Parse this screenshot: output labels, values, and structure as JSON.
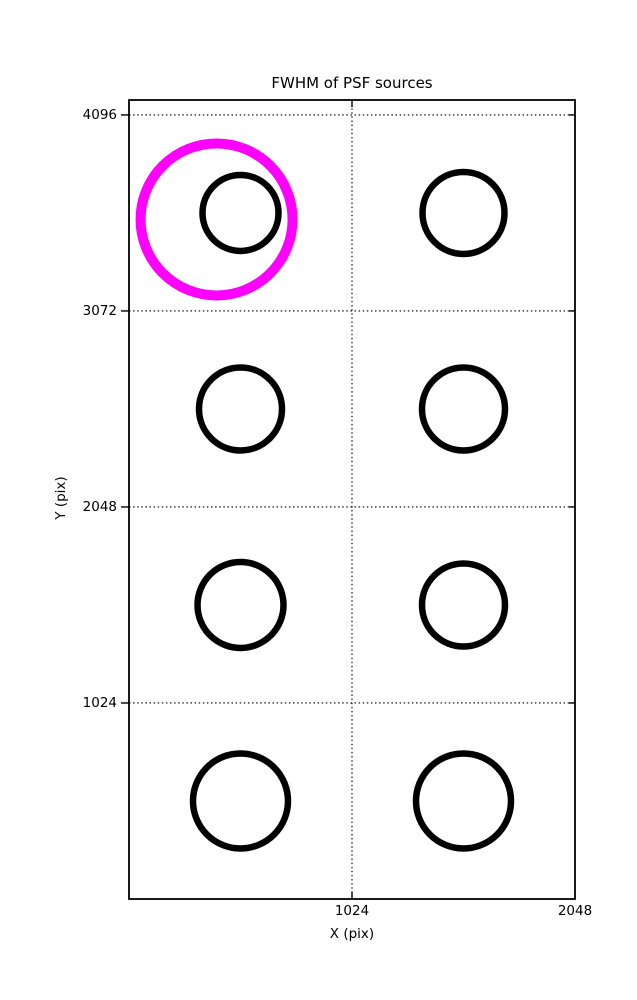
{
  "chart_data": {
    "type": "scatter",
    "title": "FWHM of PSF sources",
    "xlabel": "X (pix)",
    "ylabel": "Y (pix)",
    "xlim": [
      0,
      2048
    ],
    "ylim": [
      0,
      4174
    ],
    "xticks": [
      1024,
      2048
    ],
    "yticks": [
      1024,
      2048,
      3072,
      4096
    ],
    "grid": "dotted",
    "legend": "none",
    "marker_color": "#000000",
    "highlight_color": "#ff00ff",
    "points": [
      {
        "x": 512,
        "y": 3584,
        "r_px": 38.0
      },
      {
        "x": 1536,
        "y": 3584,
        "r_px": 41.0
      },
      {
        "x": 512,
        "y": 2560,
        "r_px": 41.5
      },
      {
        "x": 1536,
        "y": 2560,
        "r_px": 41.5
      },
      {
        "x": 512,
        "y": 1536,
        "r_px": 43.0
      },
      {
        "x": 1536,
        "y": 1536,
        "r_px": 41.5
      },
      {
        "x": 512,
        "y": 512,
        "r_px": 47.5
      },
      {
        "x": 1536,
        "y": 512,
        "r_px": 47.5
      }
    ],
    "highlight": {
      "x": 402,
      "y": 3550,
      "r_px": 76.0
    }
  }
}
